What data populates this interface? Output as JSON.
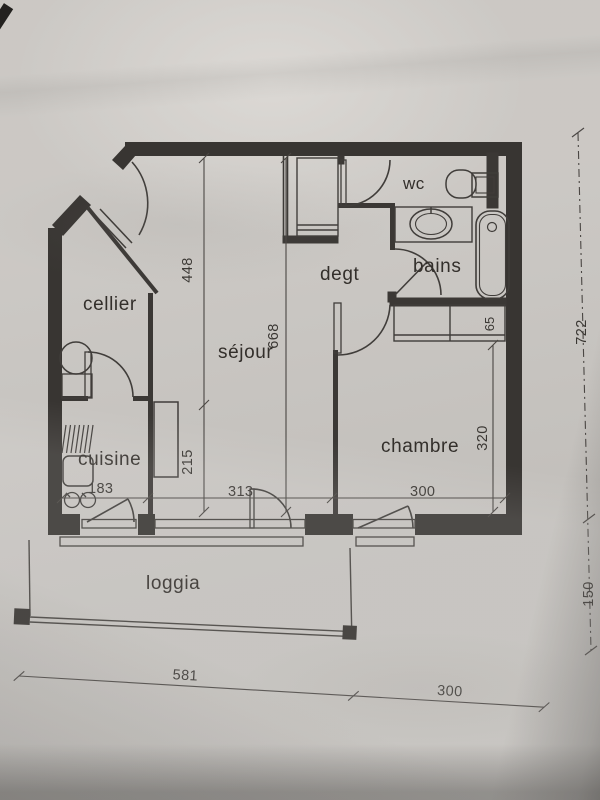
{
  "document": {
    "type": "apartment floor plan (scanned photo)",
    "colors": {
      "paper": "#cfccc8",
      "ink": "#363330",
      "wall_fill": "#383532"
    }
  },
  "plan": {
    "rooms": {
      "cellier": "cellier",
      "cuisine": "cuisine",
      "sejour": "séjour",
      "degt": "degt",
      "wc": "wc",
      "bains": "bains",
      "chambre": "chambre",
      "loggia": "loggia"
    },
    "dims": {
      "sejour_upper": "448",
      "sejour_lower": "215",
      "sejour_total": "668",
      "cuisine_width": "183",
      "sejour_width": "313",
      "chambre_width": "300",
      "closet_depth": "65",
      "chambre_depth": "320",
      "right_total": "722",
      "loggia_depth": "150",
      "bottom_left": "581",
      "bottom_right": "300"
    },
    "fixtures": [
      "entry-door",
      "water-heater",
      "drainboard",
      "kitchen-sink",
      "kitchen-hob",
      "counter",
      "wardrobe",
      "toilet",
      "washbasin",
      "bathtub",
      "closet",
      "loggia-railing"
    ]
  }
}
